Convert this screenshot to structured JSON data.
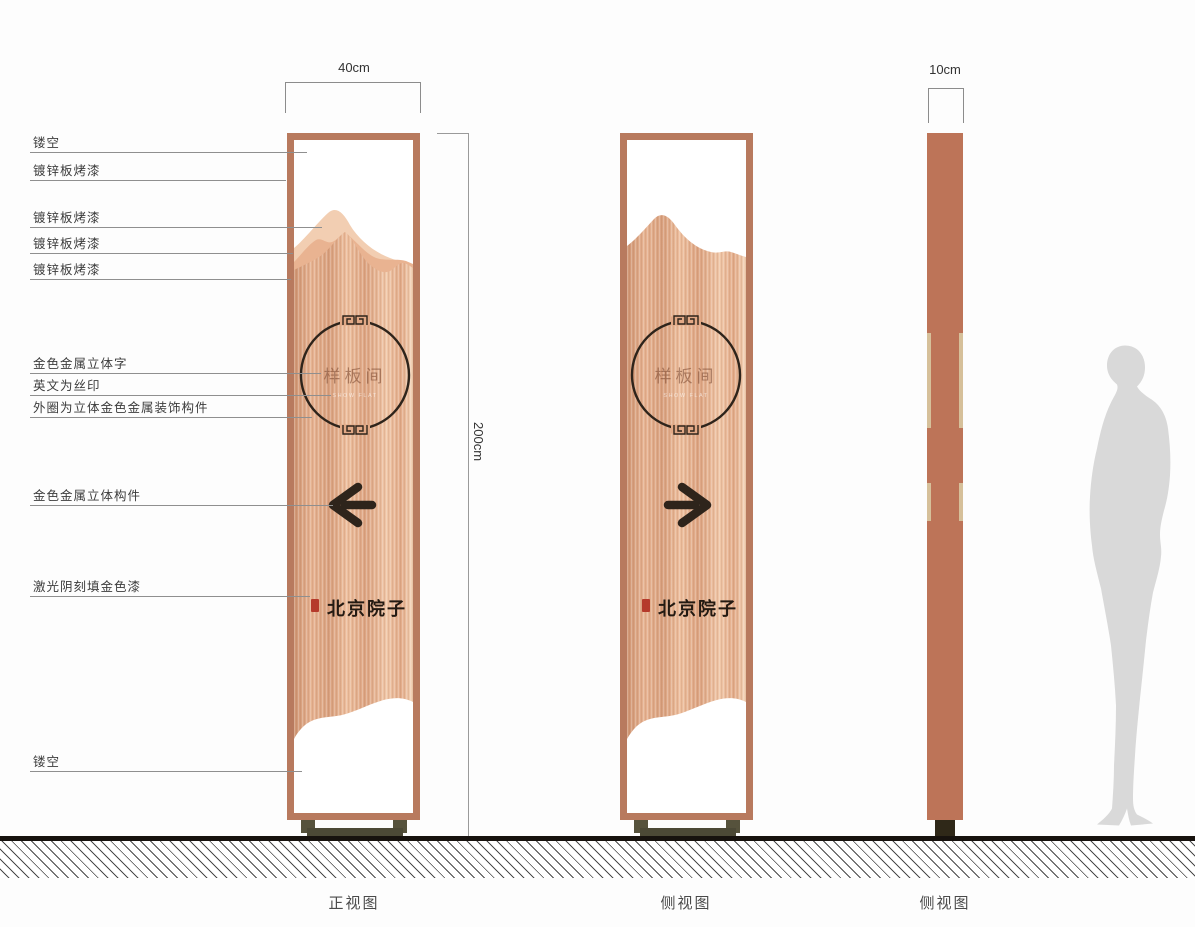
{
  "dimensions": {
    "width_label": "40cm",
    "height_label": "200cm",
    "depth_label": "10cm"
  },
  "callouts": [
    {
      "label": "镂空"
    },
    {
      "label": "镀锌板烤漆"
    },
    {
      "label": "镀锌板烤漆"
    },
    {
      "label": "镀锌板烤漆"
    },
    {
      "label": "镀锌板烤漆"
    },
    {
      "label": "金色金属立体字"
    },
    {
      "label": "英文为丝印"
    },
    {
      "label": "外圈为立体金色金属装饰构件"
    },
    {
      "label": "金色金属立体构件"
    },
    {
      "label": "激光阴刻填金色漆"
    },
    {
      "label": "镂空"
    }
  ],
  "sign": {
    "room_label": "样板间",
    "room_label_en": "SHOW FLAT",
    "brand": "北京院子"
  },
  "views": {
    "front_caption": "正视图",
    "side_caption": "侧视图",
    "profile_caption": "侧视图"
  },
  "colors": {
    "copper_frame": "#b87a5e",
    "copper_solid": "#bd7458",
    "ink": "#2e241b",
    "tan": "#d6c09a",
    "base_olive": "#56523c",
    "seal_red": "#b53a2b",
    "silhouette": "#d9d9d9"
  }
}
